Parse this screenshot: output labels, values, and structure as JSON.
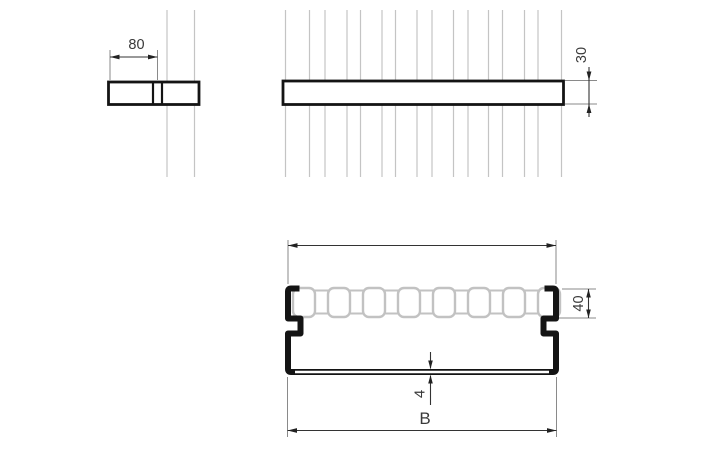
{
  "labels": {
    "side_width": "80",
    "front_height": "30",
    "section_height": "40",
    "section_thickness": "4",
    "section_width": "B"
  },
  "colors": {
    "background": "#ffffff",
    "outline": "#141414",
    "dimension_line": "#333333",
    "extension_line": "#8a8a8a",
    "dimension_text": "#3a3a3a",
    "reference_wire": "#c4c4c4"
  }
}
